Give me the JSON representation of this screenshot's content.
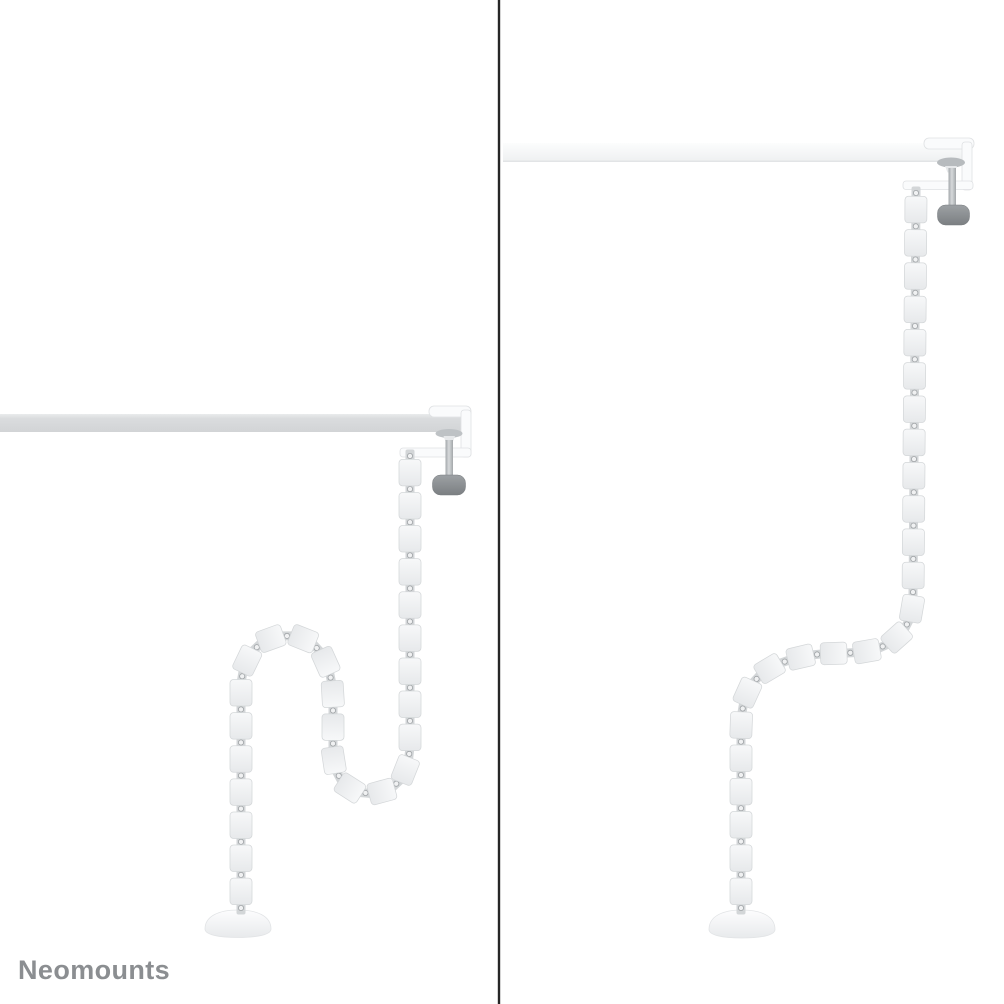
{
  "brand": {
    "logo_text": "Neomounts"
  },
  "colors": {
    "background": "#ffffff",
    "divider": "#262626",
    "logo": "#8b8e91",
    "desk_left_light": "#e9ebec",
    "desk_left": "#dadcde",
    "desk_left_dark": "#d2d4d6",
    "desk_right_light": "#fcfdfd",
    "desk_right": "#eef0f1",
    "desk_right_edge": "#e2e4e6",
    "clamp_white": "#fafbfc",
    "clamp_stroke": "#dfe1e3",
    "cone": "#bec2c5",
    "cone_right": "#b7bbbe",
    "cone_lower": "#e6e8ea",
    "rod_light": "#d7dadc",
    "rod_dark": "#a3a7aa",
    "knob_light": "#9da1a4",
    "knob_dark": "#7b7f82",
    "knob_stroke": "#777b7e",
    "segment_fill_top": "#f7f8f9",
    "segment_fill_bottom": "#e7e9eb",
    "segment_stroke": "#d4d7d9",
    "connector_fill": "#d3d6d8",
    "connector_face": "#f0f1f2",
    "connector_ring": "#9ea2a5",
    "base_top": "#fdfdfe",
    "base_bottom": "#e8eaec",
    "base_stroke": "#e2e4e6"
  },
  "spines": {
    "left": {
      "path": "M 410 456 L 410 740 C 410 772 399 791 373 793 C 347 795 333 777 333 749 L 333 702 C 333 668 321 638 291 636 C 261 634 241 655 241 691 L 241 908",
      "spacing": 33.2,
      "segment_length": 26.5,
      "segment_width": 22
    },
    "right": {
      "path": "M 916 193 L 913 597 C 913 626 897 645 868 651 C 846 655 823 651 797 658 C 772 664 752 676 745 699 C 741 712 741 724 741 747 L 741 908",
      "spacing": 33.2,
      "segment_length": 26.5,
      "segment_width": 22
    }
  }
}
